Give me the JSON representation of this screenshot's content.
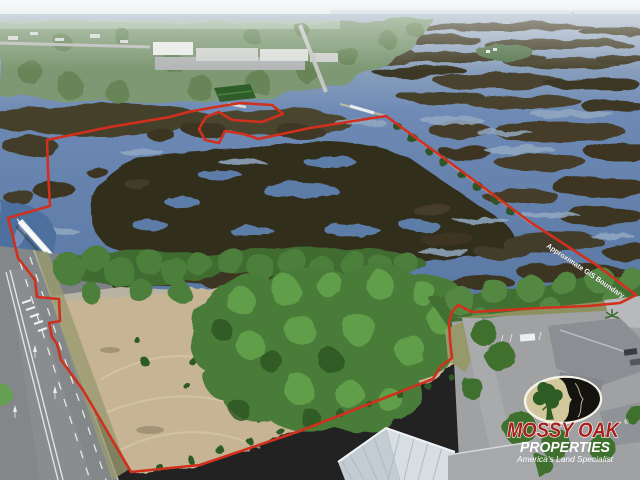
{
  "photo": {
    "boundary": {
      "label": "Approximate GIS Boundary",
      "color": "#d0301d",
      "label_fill": "#ffffff",
      "label_stroke": "#1a1a1a"
    },
    "logo": {
      "line1": "MOSSY OAK",
      "registered": "®",
      "line2": "PROPERTIES",
      "tagline": "America's Land Specialist",
      "red": "#a6201c",
      "white": "#ffffff",
      "oval_khaki": "#d3c79e",
      "oval_black": "#15130f",
      "tree_green": "#2d5c24"
    }
  }
}
